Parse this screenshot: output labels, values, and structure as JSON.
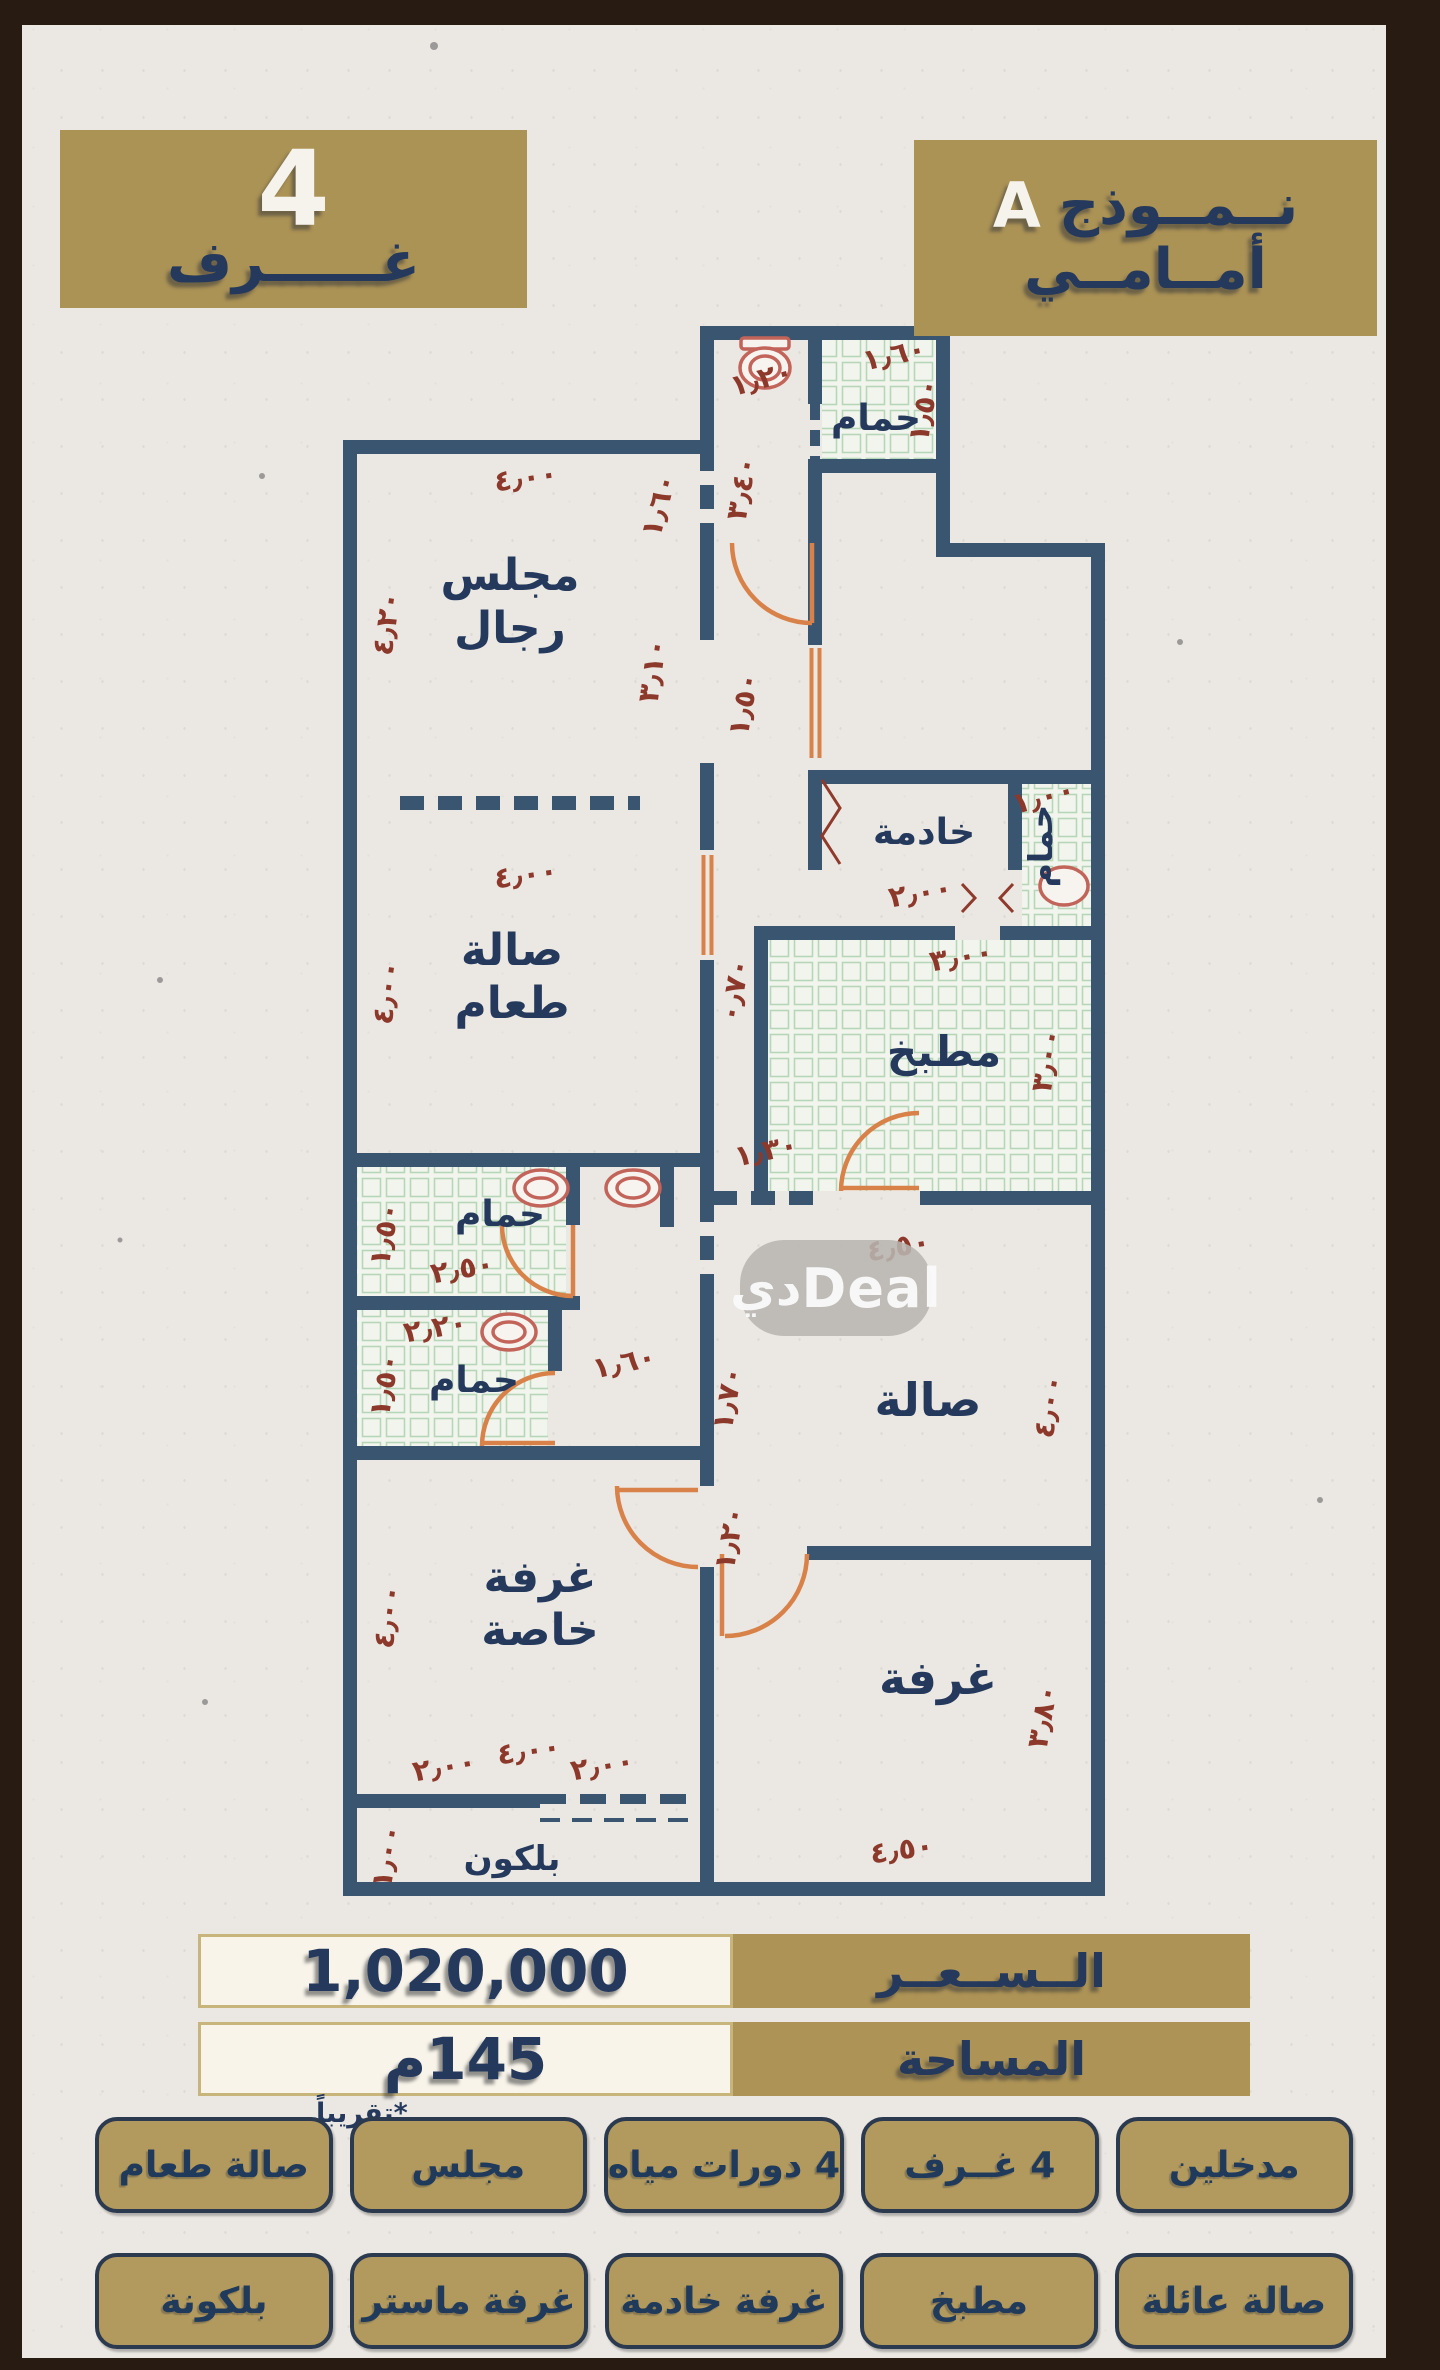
{
  "header": {
    "left_badge": {
      "number": "4",
      "label": "غــــــرف"
    },
    "right_badge": {
      "title_arabic": "نــمــوذج",
      "title_latin": "A",
      "subtitle": "أمــامــي"
    }
  },
  "watermark": {
    "arabic": "دي",
    "latin": "Deal"
  },
  "pricing": {
    "price_label": "الــســعــر",
    "price_value": "1,020,000",
    "area_label": "المساحة",
    "area_value": "145م",
    "area_note": "*تقريباً"
  },
  "features": {
    "row1": [
      "مدخلين",
      "4 غــرف",
      "4 دورات مياه",
      "مجلس",
      "صالة طعام"
    ],
    "row2": [
      "صالة عائلة",
      "مطبخ",
      "غرفة خادمة",
      "غرفة ماستر",
      "بلكونة"
    ]
  },
  "plan": {
    "rooms": [
      {
        "name": "majlis",
        "lines": [
          "مجلس",
          "رجال"
        ],
        "x": 510,
        "y": 590,
        "size": 44
      },
      {
        "name": "dining",
        "lines": [
          "صالة",
          "طعام"
        ],
        "x": 512,
        "y": 965,
        "size": 44
      },
      {
        "name": "bath-top",
        "lines": [
          "حمام"
        ],
        "x": 876,
        "y": 430,
        "size": 36
      },
      {
        "name": "maid",
        "lines": [
          "خادمة"
        ],
        "x": 924,
        "y": 844,
        "size": 36
      },
      {
        "name": "maid-bath",
        "lines": [
          "حمام"
        ],
        "x": 1052,
        "y": 846,
        "size": 33,
        "rot": -90
      },
      {
        "name": "kitchen",
        "lines": [
          "مطبخ"
        ],
        "x": 944,
        "y": 1066,
        "size": 42
      },
      {
        "name": "bath-1",
        "lines": [
          "حمام"
        ],
        "x": 500,
        "y": 1226,
        "size": 36
      },
      {
        "name": "bath-2",
        "lines": [
          "حمام"
        ],
        "x": 474,
        "y": 1392,
        "size": 36
      },
      {
        "name": "hall",
        "lines": [
          "صالة"
        ],
        "x": 928,
        "y": 1416,
        "size": 46
      },
      {
        "name": "private-room",
        "lines": [
          "غرفة",
          "خاصة"
        ],
        "x": 540,
        "y": 1592,
        "size": 44
      },
      {
        "name": "room",
        "lines": [
          "غرفة"
        ],
        "x": 938,
        "y": 1694,
        "size": 46
      },
      {
        "name": "balcony",
        "lines": [
          "بلكون"
        ],
        "x": 512,
        "y": 1870,
        "size": 34
      }
    ],
    "dims": [
      {
        "t": "٤٫٠٠",
        "x": 527,
        "y": 487,
        "r": -8
      },
      {
        "t": "٤٫٢٠",
        "x": 396,
        "y": 625,
        "r": -82
      },
      {
        "t": "٣٫١٠",
        "x": 662,
        "y": 672,
        "r": -82
      },
      {
        "t": "١٫٦٠",
        "x": 668,
        "y": 508,
        "r": -75
      },
      {
        "t": "١٫٢٠",
        "x": 764,
        "y": 388,
        "r": -15
      },
      {
        "t": "٣٫٤٠",
        "x": 751,
        "y": 490,
        "r": -80
      },
      {
        "t": "١٫٥٠",
        "x": 753,
        "y": 706,
        "r": -80
      },
      {
        "t": "١٫٦٠",
        "x": 896,
        "y": 364,
        "r": -12
      },
      {
        "t": "١٫٥٠",
        "x": 933,
        "y": 412,
        "r": -80
      },
      {
        "t": "٤٫٠٠",
        "x": 527,
        "y": 884,
        "r": -8
      },
      {
        "t": "٤٫٠٠",
        "x": 396,
        "y": 994,
        "r": -82
      },
      {
        "t": "٢٫٠٠",
        "x": 922,
        "y": 902,
        "r": -10
      },
      {
        "t": "١٫٠٠",
        "x": 1046,
        "y": 806,
        "r": -15
      },
      {
        "t": "٣٫٠٠",
        "x": 963,
        "y": 966,
        "r": -10
      },
      {
        "t": "٣٫٠٠",
        "x": 1056,
        "y": 1062,
        "r": -80
      },
      {
        "t": "٠٫٧٠",
        "x": 744,
        "y": 992,
        "r": -80
      },
      {
        "t": "١٫٣٠",
        "x": 768,
        "y": 1160,
        "r": -12
      },
      {
        "t": "٤٫٥٠",
        "x": 900,
        "y": 1256,
        "r": -10
      },
      {
        "t": "٤٫٠٠",
        "x": 1058,
        "y": 1408,
        "r": -80
      },
      {
        "t": "١٫٧٠",
        "x": 737,
        "y": 1400,
        "r": -80
      },
      {
        "t": "١٫٢٠",
        "x": 739,
        "y": 1540,
        "r": -80
      },
      {
        "t": "١٫٥٠",
        "x": 394,
        "y": 1236,
        "r": -80
      },
      {
        "t": "٢٫٥٠",
        "x": 464,
        "y": 1278,
        "r": -10
      },
      {
        "t": "٢٫٢٠",
        "x": 437,
        "y": 1337,
        "r": -10
      },
      {
        "t": "١٫٥٠",
        "x": 394,
        "y": 1387,
        "r": -80
      },
      {
        "t": "١٫٦٠",
        "x": 626,
        "y": 1372,
        "r": -12
      },
      {
        "t": "٤٫٠٠",
        "x": 397,
        "y": 1618,
        "r": -82
      },
      {
        "t": "٢٫٠٠",
        "x": 446,
        "y": 1776,
        "r": -10
      },
      {
        "t": "٤٫٠٠",
        "x": 530,
        "y": 1760,
        "r": -8
      },
      {
        "t": "٢٫٠٠",
        "x": 604,
        "y": 1775,
        "r": -10
      },
      {
        "t": "٣٫٨٠",
        "x": 1052,
        "y": 1718,
        "r": -80
      },
      {
        "t": "٤٫٥٠",
        "x": 903,
        "y": 1859,
        "r": -8
      },
      {
        "t": "١٫٠٠",
        "x": 396,
        "y": 1858,
        "r": -80
      }
    ]
  }
}
